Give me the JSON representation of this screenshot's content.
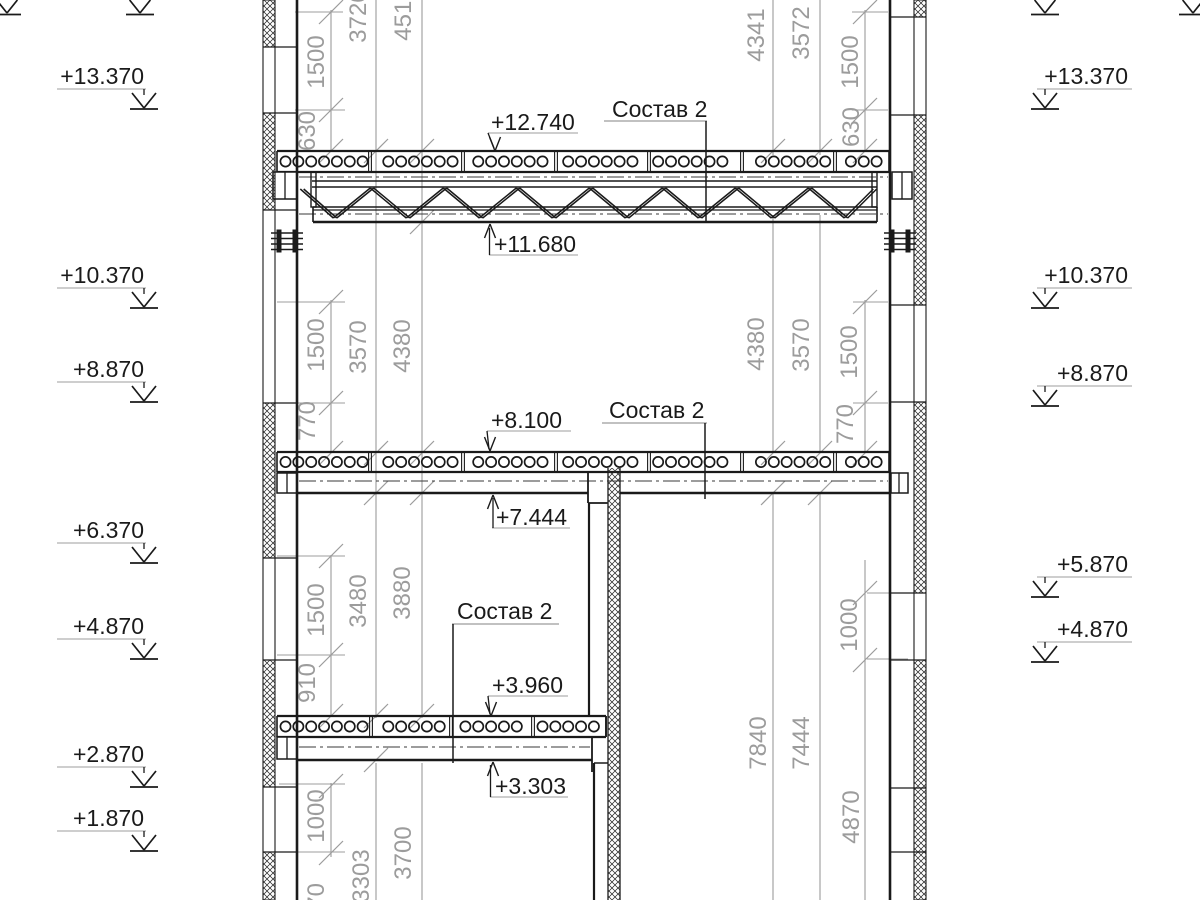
{
  "canvas": {
    "width": 1200,
    "height": 900,
    "bg": "#ffffff",
    "ink": "#1a1a1a",
    "gray": "#9c9c9c",
    "dash": "#3a3a3a"
  },
  "datum_marks": {
    "left": {
      "text_anchor_x": 144,
      "underline_x1": 57,
      "underline_x2": 146,
      "arrow_cx": 144,
      "items": [
        {
          "label": "+13.370",
          "underline_y": 89
        },
        {
          "label": "+10.370",
          "underline_y": 288
        },
        {
          "label": "+8.870",
          "underline_y": 382
        },
        {
          "label": "+6.370",
          "underline_y": 543
        },
        {
          "label": "+4.870",
          "underline_y": 639
        },
        {
          "label": "+2.870",
          "underline_y": 767
        },
        {
          "label": "+1.870",
          "underline_y": 831
        }
      ]
    },
    "right": {
      "text_anchor_x": 1128,
      "underline_x1": 1037,
      "underline_x2": 1132,
      "arrow_cx": 1045,
      "items": [
        {
          "label": "+13.370",
          "underline_y": 89
        },
        {
          "label": "+10.370",
          "underline_y": 288
        },
        {
          "label": "+8.870",
          "underline_y": 386
        },
        {
          "label": "+5.870",
          "underline_y": 577
        },
        {
          "label": "+4.870",
          "underline_y": 642
        }
      ]
    },
    "partial_top_cx": [
      140,
      1045,
      7,
      1193
    ]
  },
  "elevation_callouts": [
    {
      "label": "+12.740",
      "text_x": 491,
      "baseline_y": 130,
      "underline": [
        488,
        578,
        133
      ],
      "leader": [
        488,
        133,
        494,
        148
      ],
      "arrow": {
        "x": 495,
        "y": 151,
        "dir": "down"
      }
    },
    {
      "label": "+11.680",
      "text_x": 494,
      "baseline_y": 252,
      "underline": [
        489,
        578,
        255
      ],
      "leader": [
        489.5,
        255,
        489.5,
        228
      ],
      "arrow": {
        "x": 490,
        "y": 224,
        "dir": "up"
      }
    },
    {
      "label": "+8.100",
      "text_x": 491,
      "baseline_y": 428,
      "underline": [
        487,
        571,
        431
      ],
      "leader": [
        487,
        431,
        489,
        449
      ],
      "arrow": {
        "x": 490,
        "y": 451,
        "dir": "down"
      }
    },
    {
      "label": "+7.444",
      "text_x": 496,
      "baseline_y": 525,
      "underline": [
        492,
        570,
        528
      ],
      "leader": [
        493,
        528,
        493,
        498
      ],
      "arrow": {
        "x": 493,
        "y": 495,
        "dir": "up"
      }
    },
    {
      "label": "+3.960",
      "text_x": 492,
      "baseline_y": 693,
      "underline": [
        488,
        568,
        696
      ],
      "leader": [
        488,
        696,
        490,
        714
      ],
      "arrow": {
        "x": 491,
        "y": 716,
        "dir": "down"
      }
    },
    {
      "label": "+3.303",
      "text_x": 495,
      "baseline_y": 794,
      "underline": [
        490,
        568,
        797
      ],
      "leader": [
        490.5,
        797,
        490.5,
        765
      ],
      "arrow": {
        "x": 493,
        "y": 762,
        "dir": "up"
      }
    }
  ],
  "composition_labels": [
    {
      "label": "Состав 2",
      "text_x": 612,
      "baseline_y": 117,
      "underline": [
        604,
        707,
        121
      ],
      "leader": [
        706,
        121,
        706,
        221
      ]
    },
    {
      "label": "Состав 2",
      "text_x": 609,
      "baseline_y": 418,
      "underline": [
        602,
        707,
        423
      ],
      "leader": [
        705,
        423,
        705,
        499
      ]
    },
    {
      "label": "Состав 2",
      "text_x": 457,
      "baseline_y": 619,
      "underline": [
        452,
        559,
        624
      ],
      "leader": [
        453,
        624,
        453,
        763
      ]
    }
  ],
  "dimensions": {
    "labels_left": [
      [
        "1500",
        317,
        62
      ],
      [
        "630",
        308,
        131
      ],
      [
        "3720",
        359,
        16
      ],
      [
        "4510",
        404,
        14
      ],
      [
        "1500",
        317,
        345
      ],
      [
        "770",
        308,
        421
      ],
      [
        "3570",
        359,
        347
      ],
      [
        "4380",
        403,
        346
      ],
      [
        "1500",
        317,
        610
      ],
      [
        "910",
        308,
        683
      ],
      [
        "3480",
        359,
        601
      ],
      [
        "3880",
        403,
        593
      ],
      [
        "1000",
        317,
        816
      ],
      [
        "970",
        317,
        903
      ],
      [
        "3303",
        362,
        876
      ],
      [
        "3700",
        404,
        853
      ]
    ],
    "labels_right": [
      [
        "4341",
        757,
        35
      ],
      [
        "3572",
        802,
        33
      ],
      [
        "1500",
        851,
        62
      ],
      [
        "630",
        852,
        127
      ],
      [
        "4380",
        757,
        344
      ],
      [
        "3570",
        802,
        345
      ],
      [
        "1500",
        850,
        352
      ],
      [
        "770",
        846,
        424
      ],
      [
        "1000",
        850,
        625
      ],
      [
        "7840",
        759,
        743
      ],
      [
        "7444",
        802,
        743
      ],
      [
        "4870",
        852,
        817
      ]
    ],
    "lines": [
      [
        331,
        10,
        151
      ],
      [
        331,
        300,
        453
      ],
      [
        331,
        555,
        716
      ],
      [
        331,
        783,
        857
      ],
      [
        376,
        0,
        718
      ],
      [
        376,
        763,
        900
      ],
      [
        422,
        0,
        718
      ],
      [
        422,
        763,
        900
      ],
      [
        773,
        0,
        155
      ],
      [
        773,
        215,
        453
      ],
      [
        773,
        493,
        900
      ],
      [
        820,
        0,
        155
      ],
      [
        820,
        215,
        453
      ],
      [
        820,
        493,
        900
      ],
      [
        865,
        10,
        151
      ],
      [
        865,
        300,
        453
      ],
      [
        865,
        560,
        900
      ]
    ],
    "ext_lines": [
      [
        295,
        343,
        12
      ],
      [
        295,
        345,
        110
      ],
      [
        277,
        345,
        302
      ],
      [
        277,
        345,
        403
      ],
      [
        277,
        345,
        556
      ],
      [
        277,
        345,
        655
      ],
      [
        279,
        345,
        784
      ],
      [
        277,
        345,
        852
      ],
      [
        852,
        888,
        12
      ],
      [
        852,
        888,
        110
      ],
      [
        853,
        888,
        302
      ],
      [
        853,
        888,
        403
      ],
      [
        867,
        908,
        593
      ],
      [
        867,
        908,
        659
      ]
    ],
    "ticks": [
      [
        331,
        12
      ],
      [
        331,
        110
      ],
      [
        331,
        151
      ],
      [
        331,
        302
      ],
      [
        331,
        403
      ],
      [
        331,
        453
      ],
      [
        331,
        556
      ],
      [
        331,
        655
      ],
      [
        331,
        716
      ],
      [
        331,
        786
      ],
      [
        331,
        853
      ],
      [
        865,
        12
      ],
      [
        865,
        110
      ],
      [
        865,
        151
      ],
      [
        865,
        302
      ],
      [
        865,
        403
      ],
      [
        865,
        453
      ],
      [
        865,
        593
      ],
      [
        865,
        660
      ],
      [
        376,
        151
      ],
      [
        376,
        453
      ],
      [
        376,
        493
      ],
      [
        376,
        716
      ],
      [
        376,
        760
      ],
      [
        422,
        151
      ],
      [
        422,
        222
      ],
      [
        422,
        453
      ],
      [
        422,
        493
      ],
      [
        422,
        716
      ],
      [
        773,
        151
      ],
      [
        773,
        453
      ],
      [
        773,
        493
      ],
      [
        820,
        151
      ],
      [
        820,
        453
      ],
      [
        820,
        493
      ]
    ]
  },
  "structure": {
    "walls": {
      "left": {
        "strip": [
          263,
          275
        ],
        "face_x": 297,
        "hatch": [
          [
            0,
            47
          ],
          [
            113,
            210
          ],
          [
            403,
            558
          ],
          [
            660,
            787
          ],
          [
            852,
            900
          ]
        ],
        "joints": [
          47,
          113,
          210,
          403,
          558,
          660,
          787,
          852
        ]
      },
      "right": {
        "strip": [
          914,
          926
        ],
        "face_x": 890,
        "hatch": [
          [
            0,
            17
          ],
          [
            115,
            305
          ],
          [
            402,
            593
          ],
          [
            660,
            900
          ]
        ],
        "joints": [
          17,
          115,
          305,
          402,
          593,
          660,
          788,
          852
        ]
      },
      "interior": {
        "strip": [
          608,
          620
        ],
        "y1": 468,
        "y2": 900,
        "faces": [
          [
            589,
            503,
            715
          ],
          [
            594,
            763,
            900
          ]
        ],
        "steps": [
          [
            589,
            608,
            503
          ],
          [
            594,
            608,
            763
          ]
        ]
      }
    },
    "slabs": [
      {
        "x1": 277,
        "x2": 889,
        "top": 151,
        "bot": 172,
        "joints": [
          370,
          463,
          556,
          649,
          742,
          835
        ]
      },
      {
        "x1": 277,
        "x2": 889,
        "top": 452,
        "bot": 472,
        "joints": [
          370,
          463,
          556,
          649,
          742,
          835
        ]
      },
      {
        "x1": 277,
        "x2": 606,
        "top": 716,
        "bot": 737,
        "joints": [
          371,
          451,
          533
        ]
      }
    ],
    "truss": {
      "x1": 312,
      "x2": 877,
      "top_chord_y": [
        181,
        187
      ],
      "bot_rect": [
        313,
        207,
        877,
        222
      ],
      "bot_inner_y": 210,
      "dashdot": [
        [
          177,
          299,
          888
        ],
        [
          214,
          299,
          888
        ]
      ],
      "posts": [
        [
          311,
          172,
          316,
          207
        ],
        [
          872,
          172,
          877,
          207
        ]
      ],
      "web": [
        [
          302,
          189
        ],
        [
          335,
          218
        ],
        [
          372,
          188
        ],
        [
          408,
          218
        ],
        [
          445,
          188
        ],
        [
          481,
          218
        ],
        [
          518,
          188
        ],
        [
          554,
          218
        ],
        [
          591,
          188
        ],
        [
          627,
          218
        ],
        [
          664,
          188
        ],
        [
          700,
          218
        ],
        [
          737,
          188
        ],
        [
          773,
          218
        ],
        [
          810,
          188
        ],
        [
          846,
          218
        ],
        [
          875,
          189
        ]
      ]
    },
    "beams": [
      {
        "soffit_y": 493,
        "segments": [
          [
            297,
            588
          ],
          [
            620,
            890
          ]
        ],
        "dashdot": [
          481,
          299,
          888
        ],
        "edges": [
          [
            588,
            473,
            503
          ]
        ],
        "steps": [
          [
            588,
            607,
            503
          ]
        ]
      },
      {
        "soffit_y": 760,
        "segments": [
          [
            297,
            592
          ]
        ],
        "dashdot": [
          747,
          299,
          590
        ],
        "edges": [
          [
            592,
            737,
            772
          ],
          [
            606,
            716,
            737
          ]
        ],
        "steps": []
      }
    ],
    "bearing_boxes": [
      [
        273,
        172,
        297,
        199,
        285
      ],
      [
        892,
        172,
        912,
        199,
        902
      ],
      [
        277,
        473,
        297,
        493,
        287
      ],
      [
        891,
        473,
        908,
        493,
        899
      ],
      [
        277,
        737,
        297,
        759,
        287
      ]
    ],
    "bolts": [
      {
        "bars_x": [
          276.5,
          292.5
        ],
        "bar_y": 229.5,
        "bar_w": 5,
        "bar_h": 23,
        "lx1": 271,
        "lx2": 303,
        "lines_y": [
          233,
          238.5,
          244,
          249.5
        ]
      },
      {
        "bars_x": [
          889.5,
          905.5
        ],
        "bar_y": 229.5,
        "bar_w": 5,
        "bar_h": 23,
        "lx1": 884,
        "lx2": 916,
        "lines_y": [
          233,
          238.5,
          244,
          249.5
        ]
      }
    ]
  }
}
